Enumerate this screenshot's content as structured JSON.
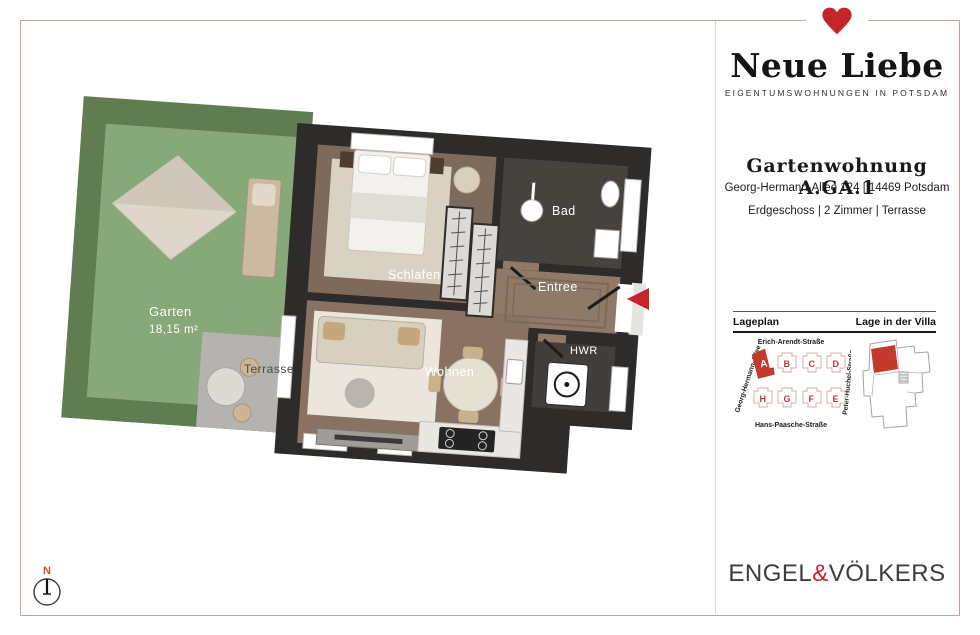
{
  "brand": {
    "name": "Neue Liebe",
    "tagline": "EIGENTUMSWOHNUNGEN IN POTSDAM",
    "heart_color": "#c5242b"
  },
  "unit": {
    "title": "Gartenwohnung A.GA.1",
    "address": "Georg-Hermann-Allee 124 | 14469 Potsdam",
    "details": "Erdgeschoss | 2 Zimmer | Terrasse"
  },
  "siteplan": {
    "heading_left": "Lageplan",
    "heading_right": "Lage in der Villa",
    "street_top": "Erich-Arendt-Straße",
    "street_bottom": "Hans-Paasche-Straße",
    "street_left": "Georg-Hermann-Allee",
    "street_right": "Peter-Huchel-Straße",
    "row_top": [
      "A",
      "B",
      "C",
      "D"
    ],
    "row_bottom": [
      "H",
      "G",
      "F",
      "E"
    ],
    "highlighted_building": "A",
    "highlight_color": "#c4392e"
  },
  "floorplan": {
    "labels": {
      "garten": "Garten",
      "garten_area": "18,15 m²",
      "terrasse": "Terrasse",
      "schlafen": "Schlafen",
      "bad": "Bad",
      "entree": "Entree",
      "wohnen": "Wohnen",
      "hwr": "HWR"
    },
    "entrance_marker_color": "#c5242b"
  },
  "compass": {
    "north": "N"
  },
  "footer": {
    "brand_left": "ENGEL",
    "amp": "&",
    "brand_right": "VÖLKERS"
  }
}
